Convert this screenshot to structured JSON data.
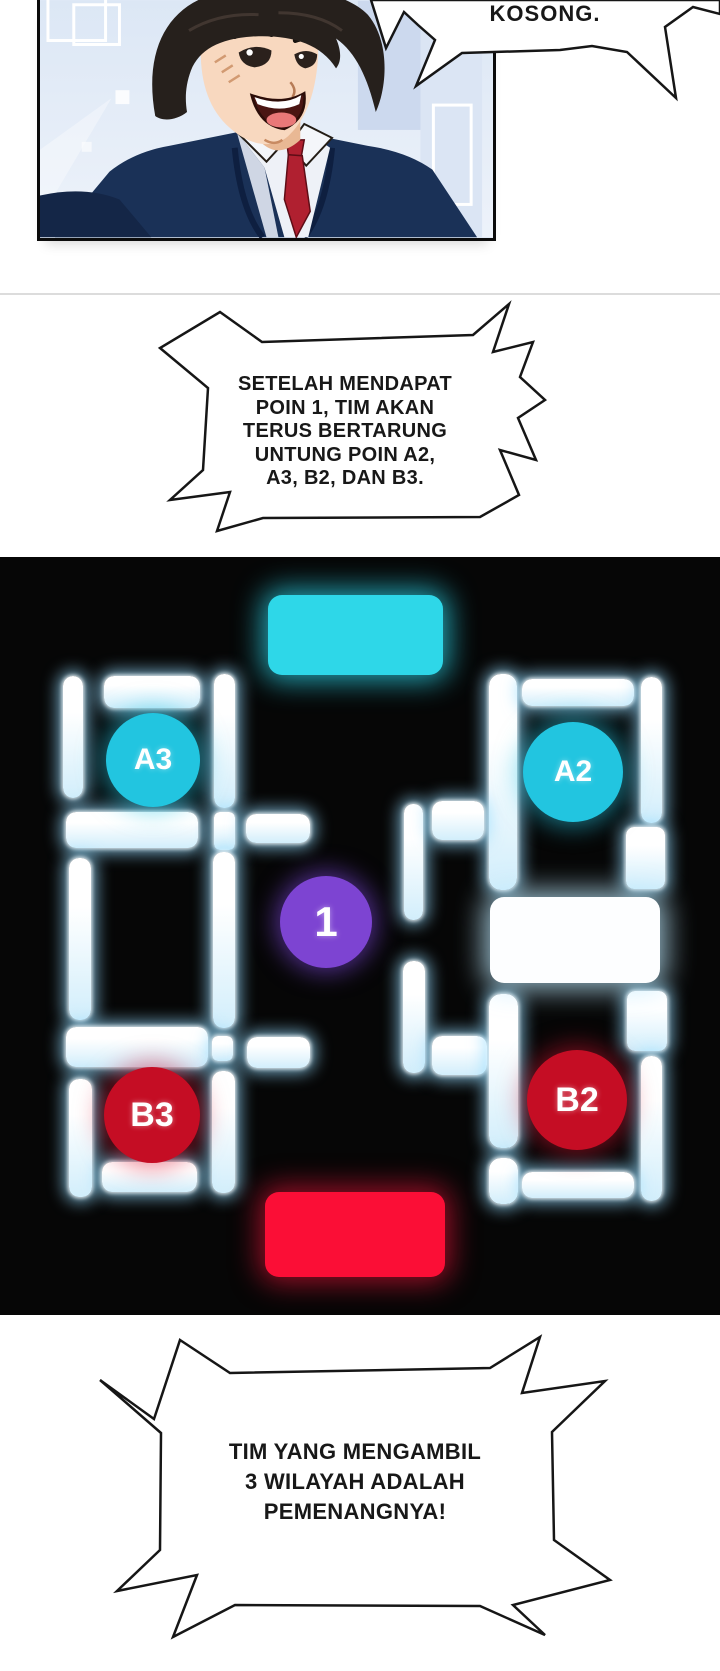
{
  "page": {
    "width": 720,
    "height": 1671,
    "background": "#ffffff"
  },
  "bubbles": {
    "top": {
      "text": "KOSONG."
    },
    "middle": {
      "text": "SETELAH MENDAPAT\nPOIN 1, TIM AKAN\nTERUS BERTARUNG\nUNTUNG POIN A2,\nA3, B2, DAN B3."
    },
    "bottom": {
      "text": "TIM YANG MENGAMBIL\n3 WILAYAH ADALAH\nPEMENANGNYA!"
    }
  },
  "map": {
    "background": "#060606",
    "zones": [
      {
        "id": "team-a-base",
        "x": 268,
        "y": 38,
        "w": 175,
        "h": 80,
        "color": "#2ed7e8",
        "glow": "rgba(45,215,235,0.75)"
      },
      {
        "id": "center-white",
        "x": 490,
        "y": 340,
        "w": 170,
        "h": 86,
        "color": "#fdfeff",
        "glow": "rgba(190,235,255,0.8)"
      },
      {
        "id": "team-b-base",
        "x": 265,
        "y": 635,
        "w": 180,
        "h": 85,
        "color": "#fb0e36",
        "glow": "rgba(250,20,60,0.6)"
      }
    ],
    "nodes": [
      {
        "id": "point-a3",
        "label": "A3",
        "cx": 153,
        "cy": 203,
        "r": 47,
        "fs": 30,
        "color": "#22c5e0",
        "glow": "rgba(40,200,230,0.55)"
      },
      {
        "id": "point-a2",
        "label": "A2",
        "cx": 573,
        "cy": 215,
        "r": 50,
        "fs": 30,
        "color": "#22c5e0",
        "glow": "rgba(40,200,230,0.55)"
      },
      {
        "id": "point-1",
        "label": "1",
        "cx": 326,
        "cy": 365,
        "r": 46,
        "fs": 42,
        "color": "#7d44d2",
        "glow": "rgba(125,70,220,0.6)"
      },
      {
        "id": "point-b3",
        "label": "B3",
        "cx": 152,
        "cy": 558,
        "r": 48,
        "fs": 34,
        "color": "#c50d24",
        "glow": "rgba(220,20,50,0.5)"
      },
      {
        "id": "point-b2",
        "label": "B2",
        "cx": 577,
        "cy": 543,
        "r": 50,
        "fs": 34,
        "color": "#c50d24",
        "glow": "rgba(220,20,50,0.5)"
      }
    ],
    "bars": [
      {
        "x": 63,
        "y": 119,
        "w": 20,
        "h": 122,
        "r": 10
      },
      {
        "x": 104,
        "y": 119,
        "w": 96,
        "h": 32,
        "r": 10
      },
      {
        "x": 214,
        "y": 117,
        "w": 21,
        "h": 134,
        "r": 10
      },
      {
        "x": 66,
        "y": 255,
        "w": 132,
        "h": 36,
        "r": 10
      },
      {
        "x": 214,
        "y": 255,
        "w": 21,
        "h": 38,
        "r": 6
      },
      {
        "x": 246,
        "y": 257,
        "w": 64,
        "h": 29,
        "r": 10
      },
      {
        "x": 69,
        "y": 301,
        "w": 22,
        "h": 162,
        "r": 10
      },
      {
        "x": 213,
        "y": 295,
        "w": 22,
        "h": 176,
        "r": 10
      },
      {
        "x": 66,
        "y": 470,
        "w": 142,
        "h": 40,
        "r": 10
      },
      {
        "x": 212,
        "y": 479,
        "w": 21,
        "h": 25,
        "r": 6
      },
      {
        "x": 247,
        "y": 480,
        "w": 63,
        "h": 31,
        "r": 10
      },
      {
        "x": 69,
        "y": 522,
        "w": 23,
        "h": 118,
        "r": 10
      },
      {
        "x": 212,
        "y": 514,
        "w": 23,
        "h": 122,
        "r": 10
      },
      {
        "x": 102,
        "y": 605,
        "w": 95,
        "h": 30,
        "r": 10
      },
      {
        "x": 489,
        "y": 117,
        "w": 28,
        "h": 216,
        "r": 12
      },
      {
        "x": 522,
        "y": 122,
        "w": 112,
        "h": 27,
        "r": 10
      },
      {
        "x": 641,
        "y": 120,
        "w": 21,
        "h": 146,
        "r": 10
      },
      {
        "x": 404,
        "y": 247,
        "w": 19,
        "h": 116,
        "r": 9
      },
      {
        "x": 432,
        "y": 244,
        "w": 52,
        "h": 39,
        "r": 10
      },
      {
        "x": 626,
        "y": 270,
        "w": 39,
        "h": 62,
        "r": 8
      },
      {
        "x": 403,
        "y": 404,
        "w": 22,
        "h": 112,
        "r": 10
      },
      {
        "x": 432,
        "y": 479,
        "w": 55,
        "h": 39,
        "r": 10
      },
      {
        "x": 489,
        "y": 437,
        "w": 29,
        "h": 154,
        "r": 12
      },
      {
        "x": 489,
        "y": 601,
        "w": 29,
        "h": 46,
        "r": 12
      },
      {
        "x": 627,
        "y": 434,
        "w": 40,
        "h": 60,
        "r": 8
      },
      {
        "x": 641,
        "y": 499,
        "w": 21,
        "h": 145,
        "r": 10
      },
      {
        "x": 522,
        "y": 615,
        "w": 112,
        "h": 26,
        "r": 10
      }
    ]
  },
  "colors": {
    "panel_border": "#0b0b0b",
    "divider": "#dcdcdc",
    "bubble_fill": "#ffffff",
    "bubble_stroke": "#161616",
    "bar_core": "#ffffff",
    "bar_tint": "#d2eefb"
  }
}
